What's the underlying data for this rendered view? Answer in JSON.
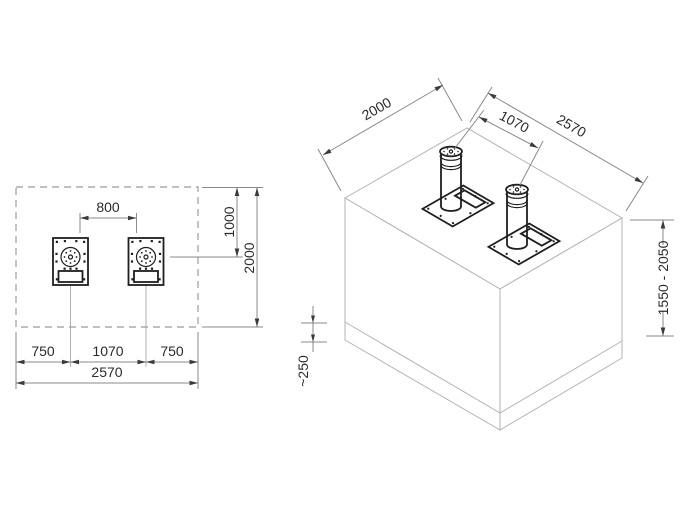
{
  "drawing": {
    "colors": {
      "line": "#1f1f1f",
      "block_line": "#b3b3b3",
      "dim_line": "#8a8a8a",
      "dim_text": "#2b2b2b",
      "background": "#ffffff"
    },
    "plan": {
      "dim_clear_between_bollards": "800",
      "dim_offset_from_edge": "1000",
      "dim_depth_total": "2000",
      "dim_margin_left": "750",
      "dim_center_spacing": "1070",
      "dim_margin_right": "750",
      "dim_width_total": "2570"
    },
    "iso": {
      "dim_depth": "2000",
      "dim_center_spacing": "1070",
      "dim_width": "2570",
      "dim_height_range": "1550 - 2050",
      "dim_base_thickness": "~250"
    }
  }
}
